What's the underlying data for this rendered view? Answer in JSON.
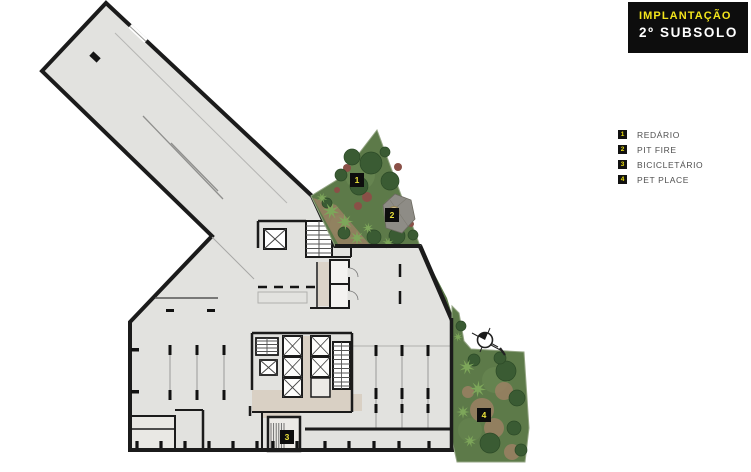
{
  "title_block": {
    "line1": "IMPLANTAÇÃO",
    "line2": "2º SUBSOLO"
  },
  "legend": {
    "items": [
      {
        "num": "1",
        "label": "REDÁRIO"
      },
      {
        "num": "2",
        "label": "PIT FIRE"
      },
      {
        "num": "3",
        "label": "BICICLETÁRIO"
      },
      {
        "num": "4",
        "label": "PET PLACE"
      }
    ]
  },
  "plan": {
    "markers": [
      {
        "num": "1"
      },
      {
        "num": "2"
      },
      {
        "num": "3"
      },
      {
        "num": "4"
      }
    ],
    "compass": "north-arrow"
  },
  "colors": {
    "accent_yellow": "#ece23a",
    "title_bg": "#0d0d0d",
    "title_text": "#ffffff",
    "legend_text": "#4f4f4f",
    "plan_fill": "#e2e2df",
    "wall": "#1b1b1b",
    "garden_green": "#5d7a49",
    "path_brown": "#9c8164",
    "corridor_beige": "#d9d0c4"
  }
}
